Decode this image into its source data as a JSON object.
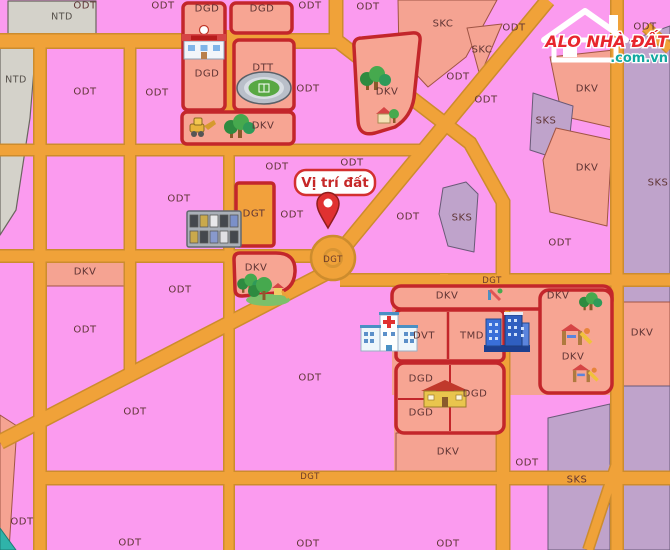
{
  "map": {
    "marker": {
      "label": "Vị trí đất"
    },
    "colors": {
      "residential_pink": "#fb9bef",
      "zone_salmon": "#f5a392",
      "zone_purple": "#bfa3cb",
      "zone_gray": "#d4d2ca",
      "zone_orange": "#f2a13c",
      "road_orange": "#f0a239",
      "road_edge": "#cd8c2d",
      "red_border": "#c3262b",
      "label_text": "#5f3434",
      "marker_red": "#d32f2f"
    },
    "labels": [
      {
        "t": "NTD",
        "x": 62,
        "y": 17,
        "cls": "ntd"
      },
      {
        "t": "NTD",
        "x": 16,
        "y": 80,
        "cls": "ntd"
      },
      {
        "t": "ODT",
        "x": 85,
        "y": 6
      },
      {
        "t": "ODT",
        "x": 163,
        "y": 6
      },
      {
        "t": "ODT",
        "x": 310,
        "y": 6
      },
      {
        "t": "ODT",
        "x": 368,
        "y": 7
      },
      {
        "t": "ODT",
        "x": 514,
        "y": 28
      },
      {
        "t": "ODT",
        "x": 645,
        "y": 27
      },
      {
        "t": "SKC",
        "x": 443,
        "y": 24
      },
      {
        "t": "SKC",
        "x": 482,
        "y": 50
      },
      {
        "t": "ODT",
        "x": 458,
        "y": 77
      },
      {
        "t": "ODT",
        "x": 486,
        "y": 100
      },
      {
        "t": "DKV",
        "x": 387,
        "y": 92
      },
      {
        "t": "ODT",
        "x": 85,
        "y": 92
      },
      {
        "t": "ODT",
        "x": 157,
        "y": 93
      },
      {
        "t": "ODT",
        "x": 308,
        "y": 89
      },
      {
        "t": "DKV",
        "x": 587,
        "y": 89
      },
      {
        "t": "SKS",
        "x": 546,
        "y": 121
      },
      {
        "t": "DKV",
        "x": 587,
        "y": 168
      },
      {
        "t": "SKS",
        "x": 658,
        "y": 183
      },
      {
        "t": "DGD",
        "x": 207,
        "y": 9
      },
      {
        "t": "DGD",
        "x": 262,
        "y": 9
      },
      {
        "t": "DGD",
        "x": 207,
        "y": 74
      },
      {
        "t": "DTT",
        "x": 263,
        "y": 68
      },
      {
        "t": "DKV",
        "x": 263,
        "y": 126
      },
      {
        "t": "ODT",
        "x": 352,
        "y": 163
      },
      {
        "t": "ODT",
        "x": 277,
        "y": 167
      },
      {
        "t": "ODT",
        "x": 179,
        "y": 199
      },
      {
        "t": "DGT",
        "x": 254,
        "y": 214,
        "s": 9
      },
      {
        "t": "ODT",
        "x": 292,
        "y": 215
      },
      {
        "t": "ODT",
        "x": 408,
        "y": 217
      },
      {
        "t": "SKS",
        "x": 462,
        "y": 218
      },
      {
        "t": "ODT",
        "x": 560,
        "y": 243
      },
      {
        "t": "DGT",
        "x": 333,
        "y": 260,
        "cls": "dgt",
        "s": 8
      },
      {
        "t": "DKV",
        "x": 85,
        "y": 272
      },
      {
        "t": "DKV",
        "x": 256,
        "y": 268
      },
      {
        "t": "DGT",
        "x": 492,
        "y": 281,
        "cls": "dgt"
      },
      {
        "t": "ODT",
        "x": 180,
        "y": 290
      },
      {
        "t": "DKV",
        "x": 447,
        "y": 296
      },
      {
        "t": "DKV",
        "x": 558,
        "y": 296
      },
      {
        "t": "ODT",
        "x": 85,
        "y": 330
      },
      {
        "t": "DVT",
        "x": 424,
        "y": 336
      },
      {
        "t": "TMD",
        "x": 472,
        "y": 336
      },
      {
        "t": "DKV",
        "x": 642,
        "y": 333
      },
      {
        "t": "DKV",
        "x": 573,
        "y": 357
      },
      {
        "t": "ODT",
        "x": 310,
        "y": 378
      },
      {
        "t": "DGD",
        "x": 421,
        "y": 379
      },
      {
        "t": "DGD",
        "x": 475,
        "y": 394
      },
      {
        "t": "DGD",
        "x": 421,
        "y": 413
      },
      {
        "t": "ODT",
        "x": 135,
        "y": 412
      },
      {
        "t": "DKV",
        "x": 448,
        "y": 452
      },
      {
        "t": "ODT",
        "x": 527,
        "y": 463
      },
      {
        "t": "DGT",
        "x": 310,
        "y": 477,
        "cls": "dgt"
      },
      {
        "t": "SKS",
        "x": 577,
        "y": 480
      },
      {
        "t": "ODT",
        "x": 22,
        "y": 522
      },
      {
        "t": "ODT",
        "x": 130,
        "y": 543
      },
      {
        "t": "ODT",
        "x": 308,
        "y": 544
      },
      {
        "t": "ODT",
        "x": 448,
        "y": 544
      }
    ],
    "icons": [
      {
        "name": "school-icon",
        "ref": "icon-school",
        "x": 204,
        "y": 46
      },
      {
        "name": "stadium-icon",
        "ref": "icon-stadium",
        "x": 264,
        "y": 88
      },
      {
        "name": "excavator-icon",
        "ref": "icon-excavator",
        "x": 202,
        "y": 128
      },
      {
        "name": "trees-icon",
        "ref": "icon-trees",
        "x": 240,
        "y": 127
      },
      {
        "name": "trees-icon",
        "ref": "icon-trees",
        "x": 376,
        "y": 79
      },
      {
        "name": "park-house-icon",
        "ref": "icon-park-house",
        "x": 384,
        "y": 116
      },
      {
        "name": "apartment-icon",
        "ref": "icon-apartment",
        "x": 214,
        "y": 229
      },
      {
        "name": "trees-icon",
        "ref": "icon-trees",
        "x": 250,
        "y": 284,
        "s": 0.8
      },
      {
        "name": "park-icon",
        "ref": "icon-park",
        "x": 268,
        "y": 292
      },
      {
        "name": "hospital-icon",
        "ref": "icon-hospital",
        "x": 389,
        "y": 336
      },
      {
        "name": "city-buildings-icon",
        "ref": "icon-city",
        "x": 506,
        "y": 335
      },
      {
        "name": "school-icon",
        "ref": "icon-school2",
        "x": 445,
        "y": 397
      },
      {
        "name": "mini-playground-icon",
        "ref": "icon-mini-playground",
        "x": 495,
        "y": 295
      },
      {
        "name": "trees-icon",
        "ref": "icon-trees",
        "x": 591,
        "y": 302,
        "s": 0.75
      },
      {
        "name": "playground-icon",
        "ref": "icon-playground",
        "x": 575,
        "y": 339
      },
      {
        "name": "playground-icon",
        "ref": "icon-playground",
        "x": 584,
        "y": 377,
        "s": 0.85
      }
    ]
  },
  "logo": {
    "title": "ALO NHÀ ĐẤT",
    "domain": ".com.vn"
  }
}
